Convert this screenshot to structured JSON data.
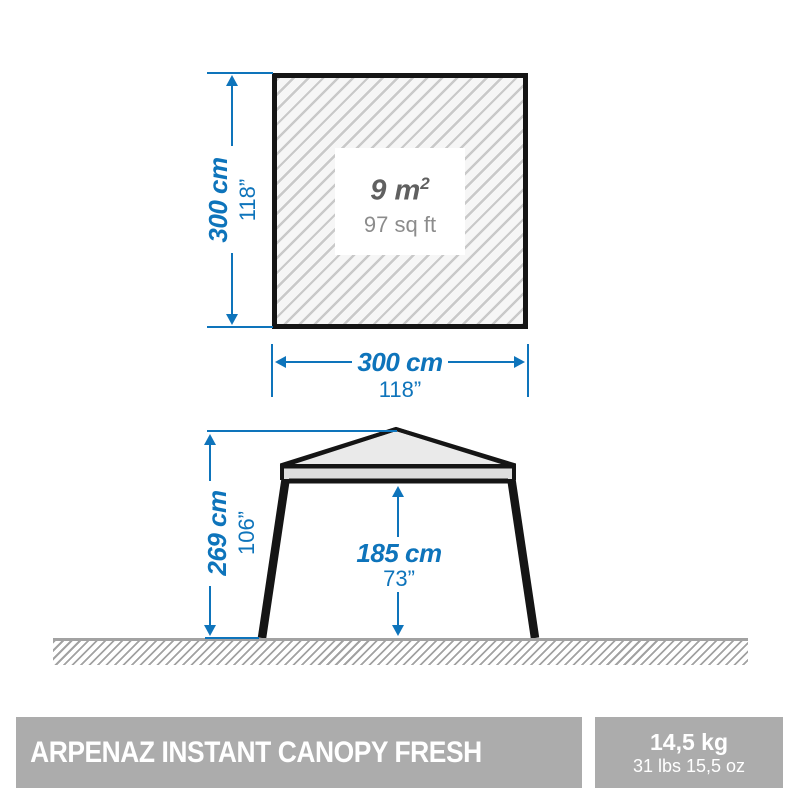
{
  "colors": {
    "dimension_blue": "#0e74bb",
    "outline_black": "#151515",
    "roof_fill": "#eaeaea",
    "fascia_fill": "#dedede",
    "footer_gray": "#acacac",
    "area_text_dark": "#606060",
    "area_text_light": "#8c8c8c"
  },
  "top_view": {
    "area_metric": "9 m",
    "area_metric_exponent": "2",
    "area_imperial": "97 sq ft",
    "width": {
      "metric": "300 cm",
      "imperial": "118”"
    },
    "depth": {
      "metric": "300 cm",
      "imperial": "118”"
    }
  },
  "side_view": {
    "total_height": {
      "metric": "269 cm",
      "imperial": "106”"
    },
    "clearance_height": {
      "metric": "185 cm",
      "imperial": "73”"
    }
  },
  "footer": {
    "product_name": "ARPENAZ INSTANT CANOPY FRESH",
    "weight": {
      "metric": "14,5 kg",
      "imperial": "31 lbs 15,5 oz"
    }
  }
}
